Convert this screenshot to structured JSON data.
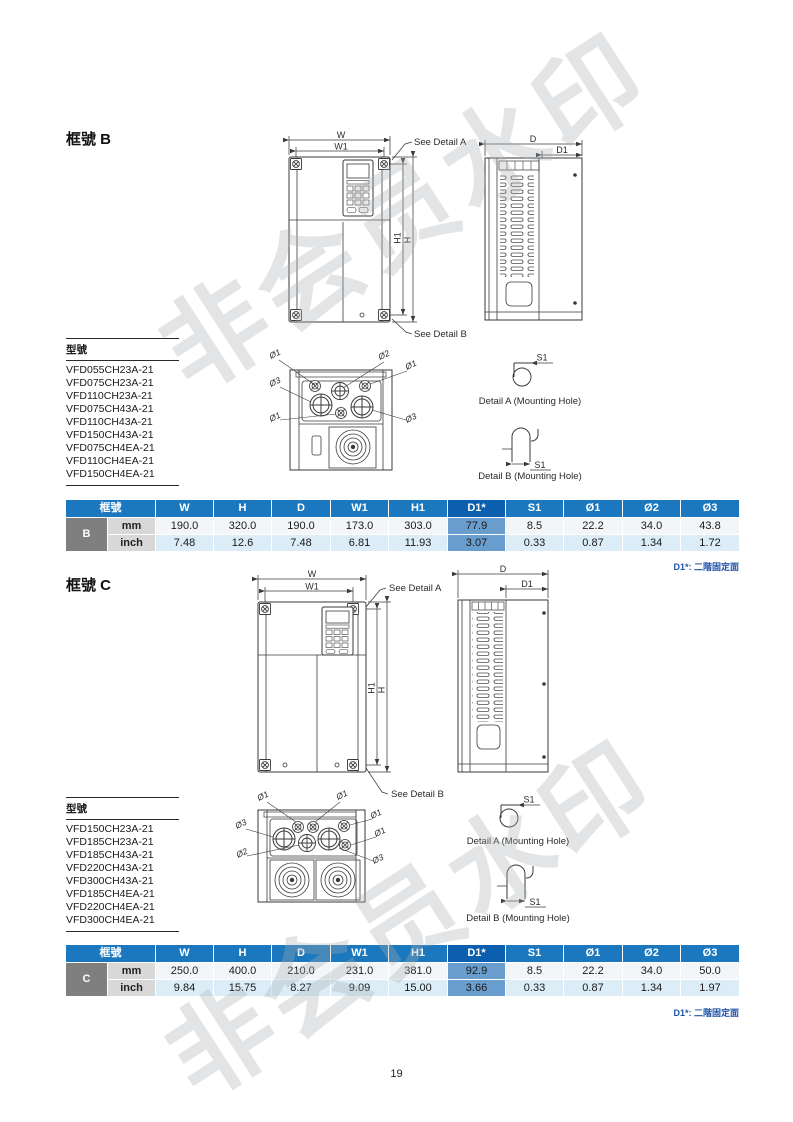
{
  "page": {
    "number": "19"
  },
  "watermark": {
    "text": "非会员水印"
  },
  "colors": {
    "table_header_blue": "#1b78be",
    "d1_header_blue": "#0b5fae",
    "d1_cell_blue": "#699dcd",
    "row_mm_bg": "#f3f6f8",
    "row_inch_bg": "#dcedf8",
    "frame_cell_gray": "#7f7f7f",
    "unit_cell_gray": "#d8d8d8",
    "note_blue": "#2053a6",
    "line_art": "#3a3a3a",
    "watermark_gray": "#a8adb2"
  },
  "labels": {
    "w": "W",
    "w1": "W1",
    "h": "H",
    "h1": "H1",
    "d": "D",
    "d1": "D1",
    "s1": "S1",
    "see_detail_a": "See Detail A",
    "see_detail_b": "See Detail B",
    "detail_a_caption": "Detail A (Mounting Hole)",
    "detail_b_caption": "Detail B (Mounting Hole)",
    "phi1": "Ø1",
    "phi2": "Ø2",
    "phi3": "Ø3"
  },
  "sections": [
    {
      "heading": "框號 B",
      "models_heading": "型號",
      "models": [
        "VFD055CH23A-21",
        "VFD075CH23A-21",
        "VFD110CH23A-21",
        "VFD075CH43A-21",
        "VFD110CH43A-21",
        "VFD150CH43A-21",
        "VFD075CH4EA-21",
        "VFD110CH4EA-21",
        "VFD150CH4EA-21"
      ],
      "table": {
        "headers": [
          "框號",
          "W",
          "H",
          "D",
          "W1",
          "H1",
          "D1*",
          "S1",
          "Ø1",
          "Ø2",
          "Ø3"
        ],
        "frame": "B",
        "rows": [
          {
            "unit": "mm",
            "values": [
              "190.0",
              "320.0",
              "190.0",
              "173.0",
              "303.0",
              "77.9",
              "8.5",
              "22.2",
              "34.0",
              "43.8"
            ]
          },
          {
            "unit": "inch",
            "values": [
              "7.48",
              "12.6",
              "7.48",
              "6.81",
              "11.93",
              "3.07",
              "0.33",
              "0.87",
              "1.34",
              "1.72"
            ]
          }
        ],
        "note": "D1*: 二階固定面"
      }
    },
    {
      "heading": "框號 C",
      "models_heading": "型號",
      "models": [
        "VFD150CH23A-21",
        "VFD185CH23A-21",
        "VFD185CH43A-21",
        "VFD220CH43A-21",
        "VFD300CH43A-21",
        "VFD185CH4EA-21",
        "VFD220CH4EA-21",
        "VFD300CH4EA-21"
      ],
      "table": {
        "headers": [
          "框號",
          "W",
          "H",
          "D",
          "W1",
          "H1",
          "D1*",
          "S1",
          "Ø1",
          "Ø2",
          "Ø3"
        ],
        "frame": "C",
        "rows": [
          {
            "unit": "mm",
            "values": [
              "250.0",
              "400.0",
              "210.0",
              "231.0",
              "381.0",
              "92.9",
              "8.5",
              "22.2",
              "34.0",
              "50.0"
            ]
          },
          {
            "unit": "inch",
            "values": [
              "9.84",
              "15.75",
              "8.27",
              "9.09",
              "15.00",
              "3.66",
              "0.33",
              "0.87",
              "1.34",
              "1.97"
            ]
          }
        ],
        "note": "D1*: 二階固定面"
      }
    }
  ]
}
